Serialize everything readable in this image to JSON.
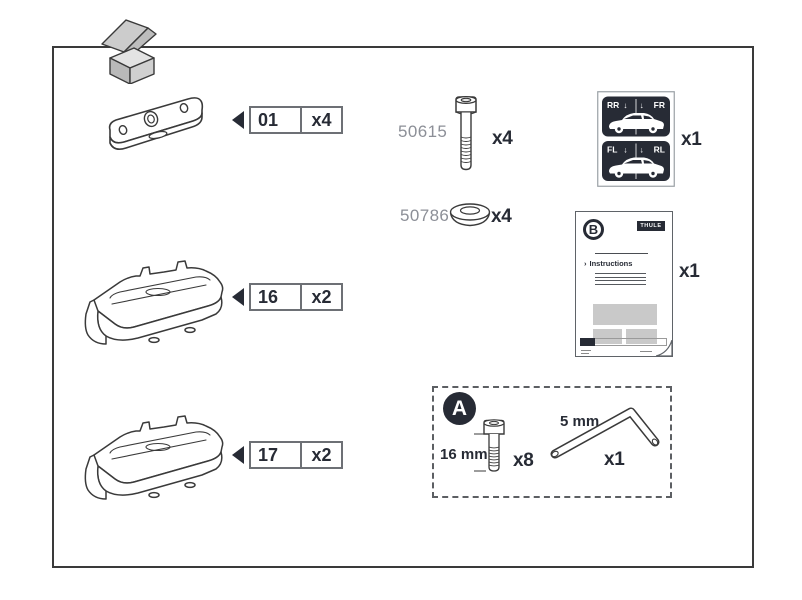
{
  "sheet": {
    "colors": {
      "ink": "#3a3a3a",
      "text_dark": "#272b35",
      "muted_gray": "#8c8f97",
      "sticker_bg": "#272b35",
      "box_fill": "#c9c9c9"
    }
  },
  "parts": [
    {
      "id": "01",
      "qty": "x4"
    },
    {
      "id": "16",
      "qty": "x2"
    },
    {
      "id": "17",
      "qty": "x2"
    }
  ],
  "hardware": [
    {
      "number": "50615",
      "qty": "x4"
    },
    {
      "number": "50786",
      "qty": "x4"
    }
  ],
  "stickers": {
    "qty": "x1",
    "top_left": "RR",
    "top_right": "FR",
    "bottom_left": "FL",
    "bottom_right": "RL",
    "arrows": "↓ ↓"
  },
  "booklet": {
    "badge": "B",
    "brand": "THULE",
    "arrow": "›",
    "title": "Instructions",
    "qty": "x1"
  },
  "tool_kit": {
    "badge": "A",
    "bolt_length": "16 mm",
    "bolt_qty": "x8",
    "key_size": "5 mm",
    "key_qty": "x1"
  }
}
